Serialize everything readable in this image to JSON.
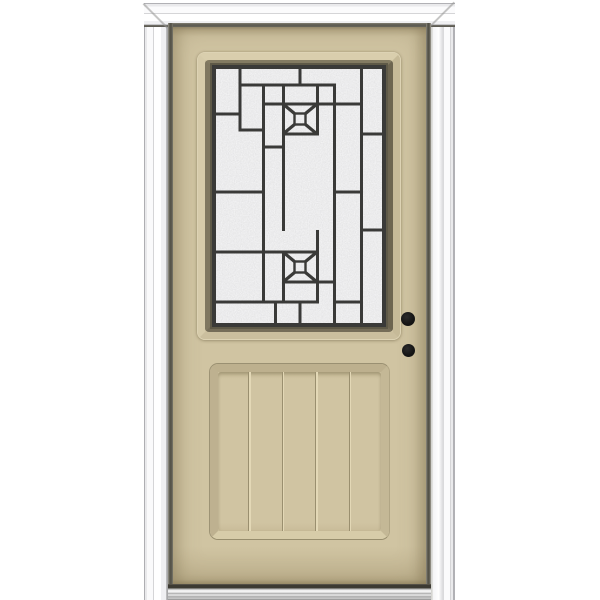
{
  "scene": {
    "description": "Product photo of a left-hand inswing exterior entry door: tan painted slab in a white brickmould frame, upper half decorative caming glass lite with two rosettes, lower recessed panel with five vertical planks, two black bore holes, aluminum sill"
  },
  "colors": {
    "background": "#ffffff",
    "door_tan": "#d0c4a2",
    "door_tan_dark": "#b4a784",
    "door_tan_light": "#ddd3b5",
    "frame_white": "#fbfbfc",
    "frame_line_gray": "#b1b1b5",
    "gap_dark": "#514f45",
    "glass_base": "#d8d8d8",
    "caming_dark": "#3a3a38",
    "hole_black": "#141414",
    "sweep_dark": "#3c3a32",
    "sill_metal": "#c9c9c9"
  },
  "glass": {
    "x": 212,
    "y": 65,
    "width": 174,
    "height": 262,
    "border": {
      "inset": 2,
      "thickness": 4
    },
    "line_thickness": 3,
    "verticals": [
      {
        "x": 28,
        "y1": 3,
        "y2": 66
      },
      {
        "x": 51.5,
        "y1": 20,
        "y2": 238
      },
      {
        "x": 71.5,
        "y1": 20,
        "y2": 166
      },
      {
        "x": 71.5,
        "y1": 187,
        "y2": 238
      },
      {
        "x": 88,
        "y1": 3,
        "y2": 21
      },
      {
        "x": 88,
        "y1": 237,
        "y2": 259
      },
      {
        "x": 105.5,
        "y1": 20,
        "y2": 70
      },
      {
        "x": 105.5,
        "y1": 165,
        "y2": 238
      },
      {
        "x": 122.5,
        "y1": 20,
        "y2": 259
      },
      {
        "x": 149.5,
        "y1": 3,
        "y2": 259
      },
      {
        "x": 63.5,
        "y1": 237,
        "y2": 259
      }
    ],
    "horizontals": [
      {
        "y": 20,
        "x1": 26.5,
        "x2": 124
      },
      {
        "y": 39,
        "x1": 50,
        "x2": 151
      },
      {
        "y": 49,
        "x1": 2,
        "x2": 29.5
      },
      {
        "y": 65,
        "x1": 26.5,
        "x2": 53
      },
      {
        "y": 69,
        "x1": 70,
        "x2": 107
      },
      {
        "y": 69,
        "x1": 148,
        "x2": 172
      },
      {
        "y": 82,
        "x1": 50,
        "x2": 73
      },
      {
        "y": 127,
        "x1": 2,
        "x2": 53
      },
      {
        "y": 127,
        "x1": 121,
        "x2": 151
      },
      {
        "y": 165,
        "x1": 148,
        "x2": 172
      },
      {
        "y": 187,
        "x1": 2,
        "x2": 107
      },
      {
        "y": 217,
        "x1": 70,
        "x2": 124
      },
      {
        "y": 237,
        "x1": 2,
        "x2": 107
      },
      {
        "y": 237,
        "x1": 121,
        "x2": 151
      }
    ],
    "rosettes": [
      {
        "cx": 88,
        "cy": 54
      },
      {
        "cx": 88,
        "cy": 202
      }
    ],
    "rosette_geometry": {
      "half_w": 17,
      "half_h": 15,
      "diamond_half": 5.5,
      "diagonal_stroke": 3.2,
      "diamond_stroke": 2.4
    }
  },
  "panel": {
    "field_x": 218,
    "grooves_page_x": [
      248,
      281.5,
      315,
      348.5
    ]
  },
  "bore_holes": [
    {
      "cx": 408,
      "cy": 319,
      "r": 7
    },
    {
      "cx": 408,
      "cy": 350,
      "r": 6.5
    }
  ]
}
